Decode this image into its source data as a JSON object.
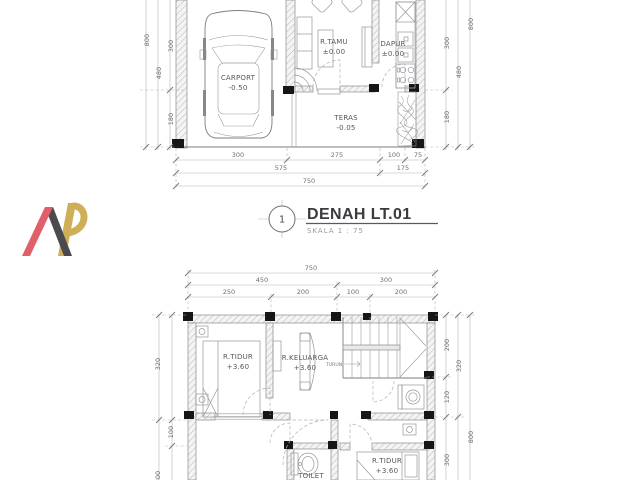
{
  "sheet": {
    "description": "House floor plan working drawing, level 1 and level 2"
  },
  "logo": {
    "monogram": "AR",
    "red": "#e0606a",
    "dark": "#4a4a50",
    "gold": "#cfae58"
  },
  "title_block": {
    "number": "1",
    "title": "DENAH LT.01",
    "scale": "SKALA 1 : 75"
  },
  "floor1": {
    "rooms": {
      "carport": {
        "name": "CARPORT",
        "level": "-0.50"
      },
      "r_tamu": {
        "name": "R.TAMU",
        "level": "±0.00"
      },
      "dapur": {
        "name": "DAPUR",
        "level": "±0.00"
      },
      "teras": {
        "name": "TERAS",
        "level": "-0.05"
      }
    },
    "dims": {
      "left_800": "800",
      "left_300": "300",
      "left_480": "480",
      "left_180": "180",
      "right_800": "800",
      "right_300": "300",
      "right_480": "480",
      "right_180": "180",
      "bottom_300": "300",
      "bottom_275": "275",
      "bottom_100": "100",
      "bottom_75": "75",
      "bottom_575": "575",
      "bottom_175": "175",
      "bottom_750": "750"
    }
  },
  "floor2": {
    "rooms": {
      "r_tidur_1": {
        "name": "R.TIDUR",
        "level": "+3.60"
      },
      "r_keluarga": {
        "name": "R.KELUARGA",
        "level": "+3.60"
      },
      "toilet": {
        "name": "TOILET"
      },
      "r_tidur_2": {
        "name": "R.TIDUR",
        "level": "+3.60"
      }
    },
    "stair_label": "TURUN",
    "dims": {
      "top_750": "750",
      "top_450": "450",
      "top_300": "300",
      "top_250": "250",
      "top_200a": "200",
      "top_100": "100",
      "top_200b": "200",
      "left_320": "320",
      "left_100": "100",
      "left_800": "800",
      "right_200": "200",
      "right_320": "320",
      "right_120": "120",
      "right_800": "800",
      "right_300": "300"
    }
  }
}
